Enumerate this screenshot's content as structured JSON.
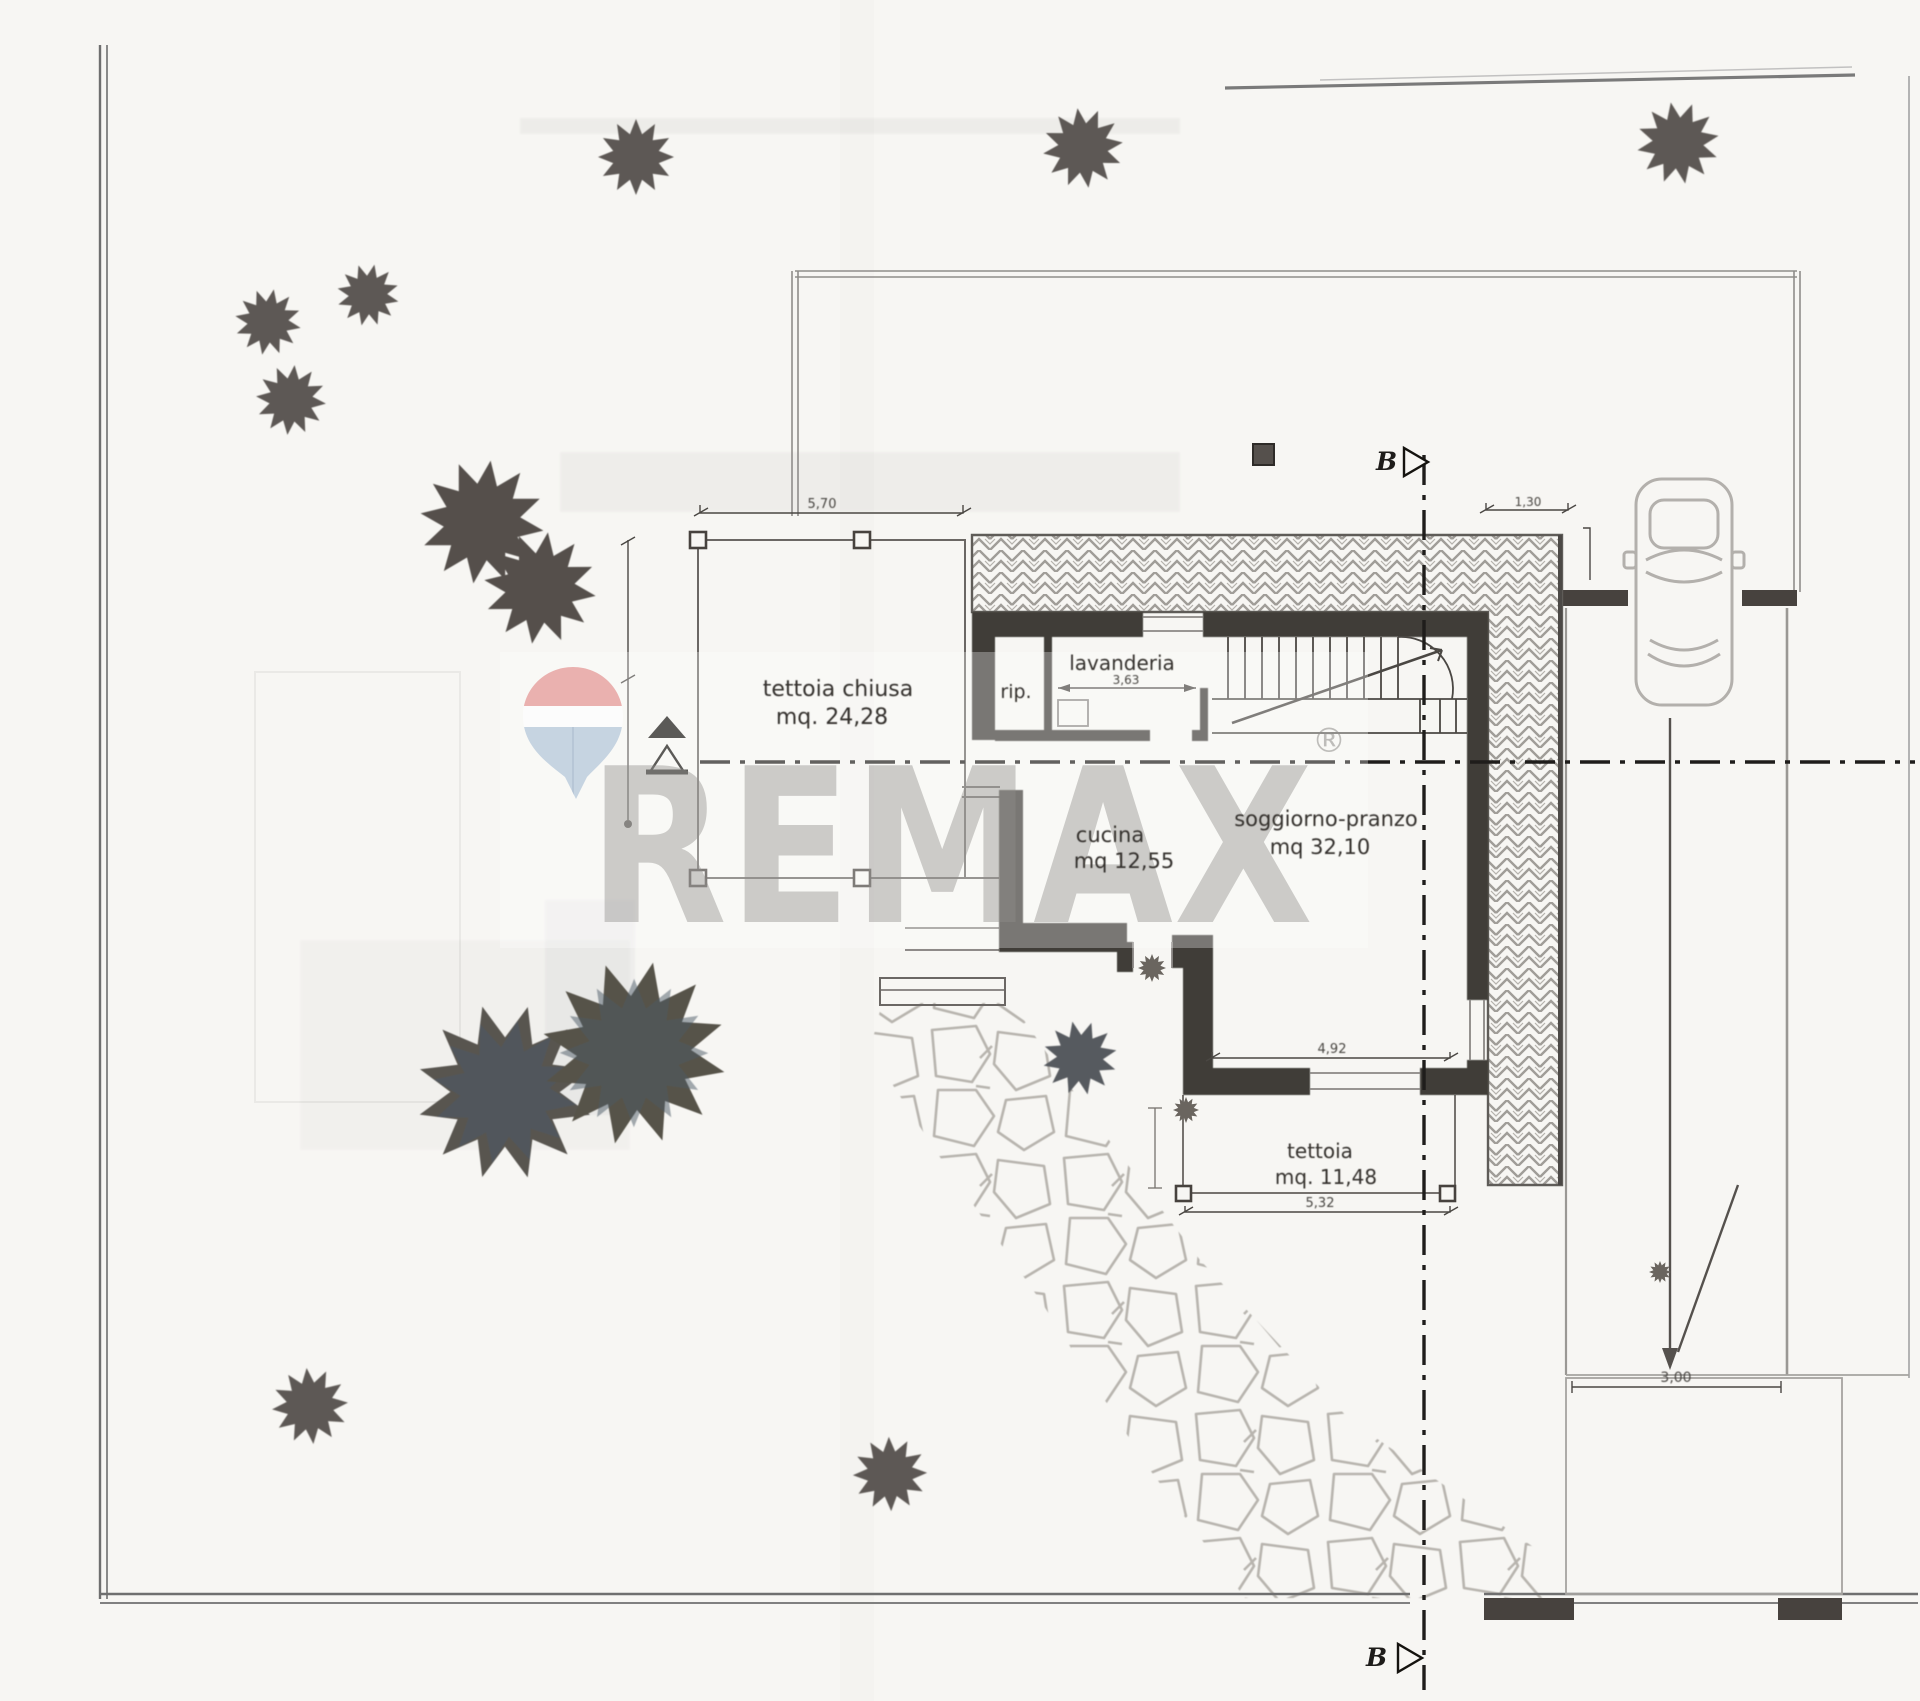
{
  "plan": {
    "watermark": {
      "brand": "REMAX",
      "registered": "®"
    },
    "rooms": [
      {
        "id": "tettoia-chiusa",
        "label": "tettoia chiusa",
        "area": "mq. 24,28"
      },
      {
        "id": "rip",
        "label": "rip.",
        "area": ""
      },
      {
        "id": "lavanderia",
        "label": "lavanderia",
        "area": ""
      },
      {
        "id": "cucina",
        "label": "cucina",
        "area": "mq 12,55"
      },
      {
        "id": "soggiorno",
        "label": "soggiorno-pranzo",
        "area": "mq  32,10"
      },
      {
        "id": "tettoia-bassa",
        "label": "tettoia",
        "area": "mq. 11,48"
      }
    ],
    "dims": {
      "tettoia_top": "5,70",
      "lavanderia_width": "3,63",
      "terrace_right": "1,30",
      "soggiorno_width": "4,92",
      "tettoia_low_width": "5,32",
      "driveway_width": "3,00"
    },
    "sections": {
      "b_top": "B",
      "b_bottom": "B"
    },
    "icons": {
      "tree": "tree-icon",
      "car": "car-top-view-icon",
      "balloon": "remax-balloon-icon",
      "section_arrow": "section-arrow-icon"
    },
    "colors": {
      "paper": "#f7f6f3",
      "wall": "#413c38",
      "boundary": "#6f6f6f",
      "tree": "#5d5854",
      "balloon_red": "#e9a8a6",
      "balloon_blue": "#bfcfdf",
      "watermark_gray": "#8f8d8a"
    }
  }
}
